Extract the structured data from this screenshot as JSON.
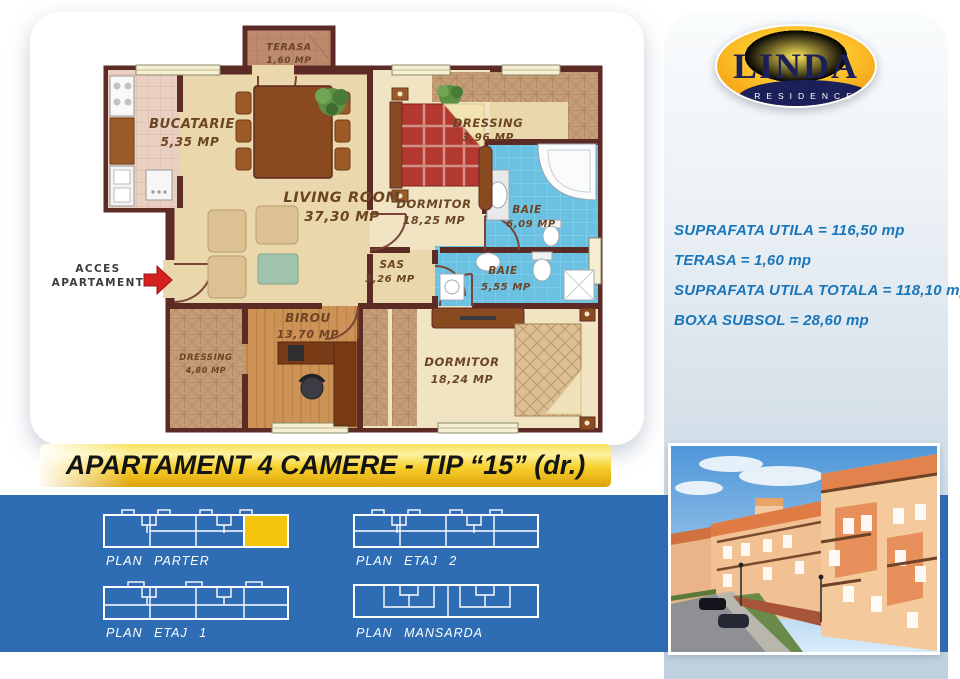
{
  "brand": {
    "name": "LINDA",
    "sub": "RESIDENCE"
  },
  "info": {
    "lines": [
      "SUPRAFATA UTILA = 116,50 mp",
      "TERASA = 1,60 mp",
      "SUPRAFATA UTILA TOTALA = 118,10 mp",
      "BOXA SUBSOL = 28,60 mp"
    ]
  },
  "banner": {
    "title": "APARTAMENT 4 CAMERE - TIP “15” (dr.)"
  },
  "floorplan": {
    "access": {
      "line1": "ACCES",
      "line2": "APARTAMENT"
    },
    "rooms": [
      {
        "name": "TERASA",
        "area": "1,60 MP"
      },
      {
        "name": "BUCATARIE",
        "area": "5,35 MP"
      },
      {
        "name": "LIVING ROOM",
        "area": "37,30 MP"
      },
      {
        "name": "DORMITOR",
        "area": "18,25 MP"
      },
      {
        "name": "DRESSING",
        "area": "3,96 MP"
      },
      {
        "name": "BAIE",
        "area": "6,09 MP"
      },
      {
        "name": "SAS",
        "area": "3,26 MP"
      },
      {
        "name": "BAIE",
        "area": "5,55 MP"
      },
      {
        "name": "BIROU",
        "area": "13,70 MP"
      },
      {
        "name": "DORMITOR",
        "area": "18,24 MP"
      },
      {
        "name": "DRESSING",
        "area": "4,80 MP"
      }
    ]
  },
  "plans": {
    "items": [
      {
        "label": "PLAN PARTER",
        "highlighted": true
      },
      {
        "label": "PLAN ETAJ 2",
        "highlighted": false
      },
      {
        "label": "PLAN ETAJ 1",
        "highlighted": false
      },
      {
        "label": "PLAN MANSARDA",
        "highlighted": false
      }
    ]
  },
  "colors": {
    "band_blue": "#2e6db4",
    "info_text_blue": "#1a76bb",
    "banner_gold": "#f6cf2b",
    "highlight_unit_yellow": "#f3c50c",
    "wall_brown": "#5d2b26",
    "logo_navy": "#1c2058",
    "logo_orange": "#f59d00",
    "bath_blue": "#6ac1e2",
    "floor_beige": "#ead7ab"
  }
}
